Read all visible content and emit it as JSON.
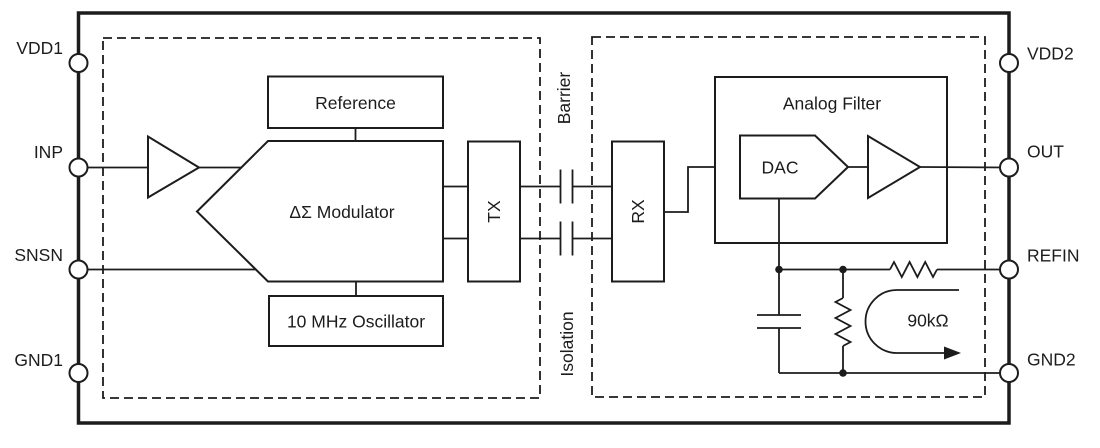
{
  "pins": {
    "left": [
      {
        "label": "VDD1"
      },
      {
        "label": "INP"
      },
      {
        "label": "SNSN"
      },
      {
        "label": "GND1"
      }
    ],
    "right": [
      {
        "label": "VDD2"
      },
      {
        "label": "OUT"
      },
      {
        "label": "REFIN"
      },
      {
        "label": "GND2"
      }
    ]
  },
  "blocks": {
    "reference": {
      "label": "Reference"
    },
    "modulator": {
      "label": "ΔΣ Modulator"
    },
    "oscillator": {
      "label": "10 MHz Oscillator"
    },
    "tx": {
      "label": "TX"
    },
    "rx": {
      "label": "RX"
    },
    "analog_filter": {
      "label": "Analog Filter"
    },
    "dac": {
      "label": "DAC"
    }
  },
  "isolation": {
    "top_label": "Barrier",
    "bottom_label": "Isolation"
  },
  "annotations": {
    "internal_resistance": "90kΩ"
  },
  "colors": {
    "line": "#1c1c1c",
    "background": "#ffffff"
  }
}
